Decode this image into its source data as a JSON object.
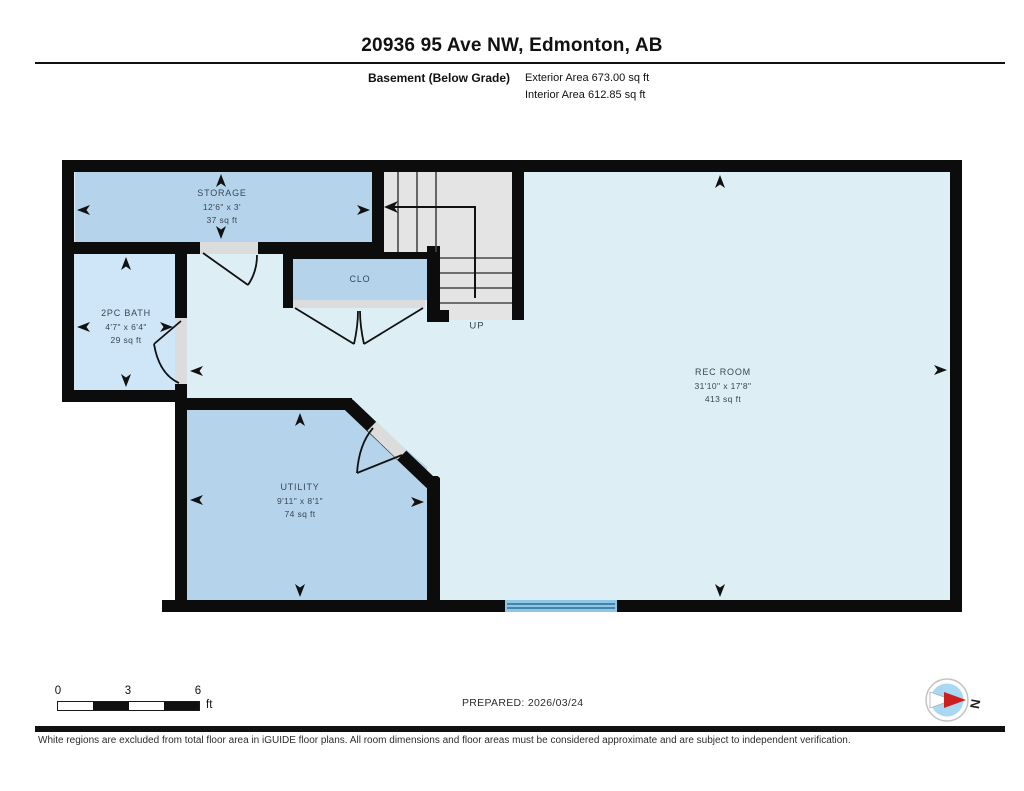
{
  "header": {
    "title": "20936 95 Ave NW, Edmonton, AB",
    "floor_label": "Basement (Below Grade)",
    "exterior_area": "Exterior Area 673.00 sq ft",
    "interior_area": "Interior Area 612.85 sq ft"
  },
  "rooms": {
    "storage": {
      "name": "STORAGE",
      "dims": "12'6\" x 3'",
      "area": "37 sq ft"
    },
    "bath": {
      "name": "2PC BATH",
      "dims": "4'7\" x 6'4\"",
      "area": "29 sq ft"
    },
    "closet": {
      "name": "CLO"
    },
    "rec_room": {
      "name": "REC ROOM",
      "dims": "31'10\" x 17'8\"",
      "area": "413 sq ft"
    },
    "utility": {
      "name": "UTILITY",
      "dims": "9'11\" x 8'1\"",
      "area": "74 sq ft"
    },
    "stairs": {
      "direction_label": "UP"
    }
  },
  "footer": {
    "scale": {
      "ticks": [
        "0",
        "3",
        "6"
      ],
      "unit": "ft"
    },
    "prepared": "PREPARED: 2026/03/24",
    "compass_letter": "N",
    "disclaimer": "White regions are excluded from total floor area in iGUIDE floor plans. All room dimensions and floor areas must be considered approximate and are subject to independent verification."
  },
  "colors": {
    "wall": "#0c0c0c",
    "room_medium_blue": "#b5d4ec",
    "room_light_blue": "#cfe6f8",
    "floor_light_cyan": "#ddeef4",
    "stairs_gray": "#e4e4e4",
    "window_blue": "#8ec7e6",
    "compass_red": "#cc1f1f",
    "compass_blue": "#a9d9f2"
  }
}
